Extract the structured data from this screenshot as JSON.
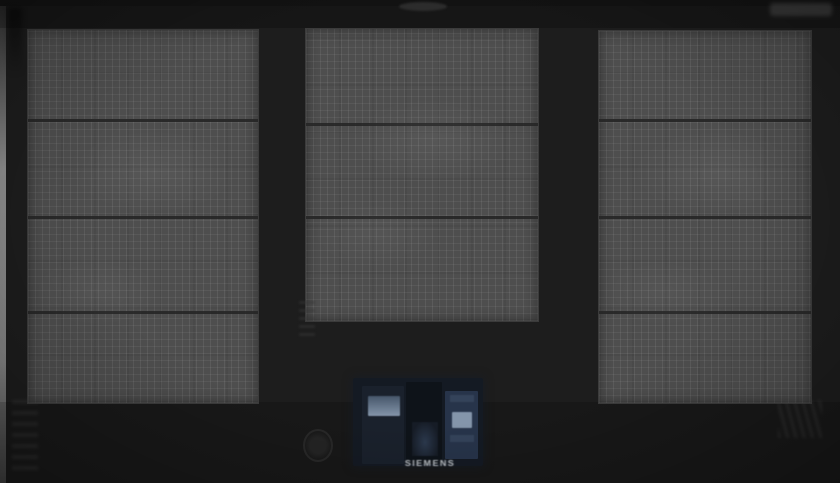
{
  "scene": {
    "subject": "Induction cooktop (top view) with three cross-hatched flex cooking zones on black glass and a central touch control panel",
    "brand": "SIEMENS"
  },
  "palette": {
    "glass": "#1d1d1d",
    "zone_fill": "#4e4e4e",
    "zone_divider": "#262626",
    "panel_base": "#141a23",
    "display_glow": "#8495aa",
    "logo_gray": "#c3c8cd"
  },
  "zones": {
    "left": {
      "label": "left flex cooking zone",
      "segments": 4
    },
    "center": {
      "label": "center flex cooking zone",
      "segments": 3
    },
    "right": {
      "label": "right flex cooking zone",
      "segments": 4
    }
  },
  "control_panel": {
    "label": "touch control display cluster",
    "displays": {
      "left": "left zone display",
      "center": "center control display",
      "right": "right zone display"
    },
    "power": "power sensor key"
  }
}
